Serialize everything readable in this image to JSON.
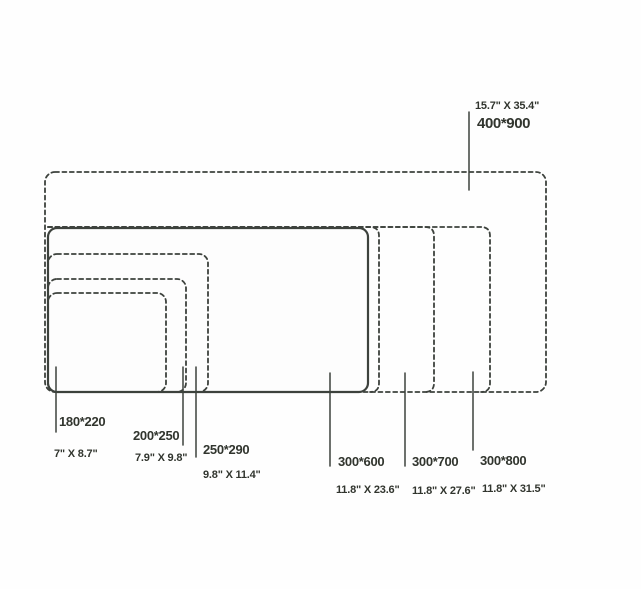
{
  "diagram": {
    "description_colors": {
      "line_color": "#3d423d",
      "text_color": "#31352e",
      "background": "#fefefe"
    },
    "sizes": [
      {
        "mm": "400*900",
        "inches": "15.7\" X 35.4\""
      },
      {
        "mm": "300*800",
        "inches": "11.8\" X 31.5\""
      },
      {
        "mm": "300*700",
        "inches": "11.8\" X 27.6\""
      },
      {
        "mm": "300*600",
        "inches": "11.8\" X 23.6\""
      },
      {
        "mm": "250*290",
        "inches": "9.8\" X 11.4\""
      },
      {
        "mm": "200*250",
        "inches": "7.9\" X 9.8\""
      },
      {
        "mm": "180*220",
        "inches": "7\" X 8.7\""
      }
    ]
  }
}
